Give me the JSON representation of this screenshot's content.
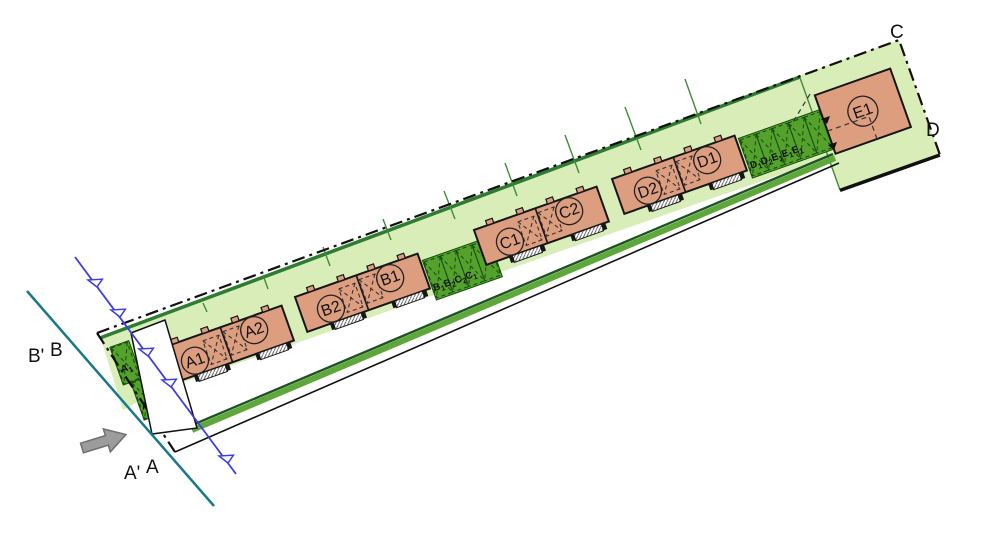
{
  "plan": {
    "corner_labels": {
      "c": "C",
      "d": "D"
    },
    "section_labels": {
      "b_prime": "B'",
      "b": "B",
      "a_prime": "A'",
      "a": "A"
    },
    "blocks": [
      {
        "units": [
          {
            "label": "A1"
          },
          {
            "label": "A2"
          }
        ]
      },
      {
        "units": [
          {
            "label": "B2"
          },
          {
            "label": "B1"
          }
        ]
      },
      {
        "units": [
          {
            "label": "C1"
          },
          {
            "label": "C2"
          }
        ]
      },
      {
        "units": [
          {
            "label": "D2"
          },
          {
            "label": "D1"
          }
        ]
      }
    ],
    "detached_building": {
      "label": "E1"
    },
    "parking_groups": [
      {
        "name": "west",
        "stalls": [
          {
            "letter": "A",
            "digit": "1"
          },
          {
            "letter": "A",
            "digit": "2"
          },
          {
            "letter": "A",
            "digit": "1"
          }
        ]
      },
      {
        "name": "middle",
        "stalls": [
          {
            "letter": "B",
            "digit": "1"
          },
          {
            "letter": "B",
            "digit": "2"
          },
          {
            "letter": "C",
            "digit": "2"
          },
          {
            "letter": "C",
            "digit": "1"
          }
        ]
      },
      {
        "name": "east",
        "stalls": [
          {
            "letter": "D",
            "digit": "1"
          },
          {
            "letter": "D",
            "digit": "2"
          },
          {
            "letter": "E",
            "digit": "1"
          },
          {
            "letter": "E",
            "digit": "1"
          },
          {
            "letter": "E",
            "digit": "1"
          }
        ]
      }
    ],
    "colors": {
      "site_green": "#d9edb8",
      "hedge_green": "#2e7c33",
      "parking_green": "#54a22c",
      "verge_green": "#5ea73b",
      "building_salmon": "#dd9e80",
      "section_teal": "#19798b",
      "section_blue": "#3d3de0",
      "arrow_gray": "#9c9c9c"
    }
  }
}
